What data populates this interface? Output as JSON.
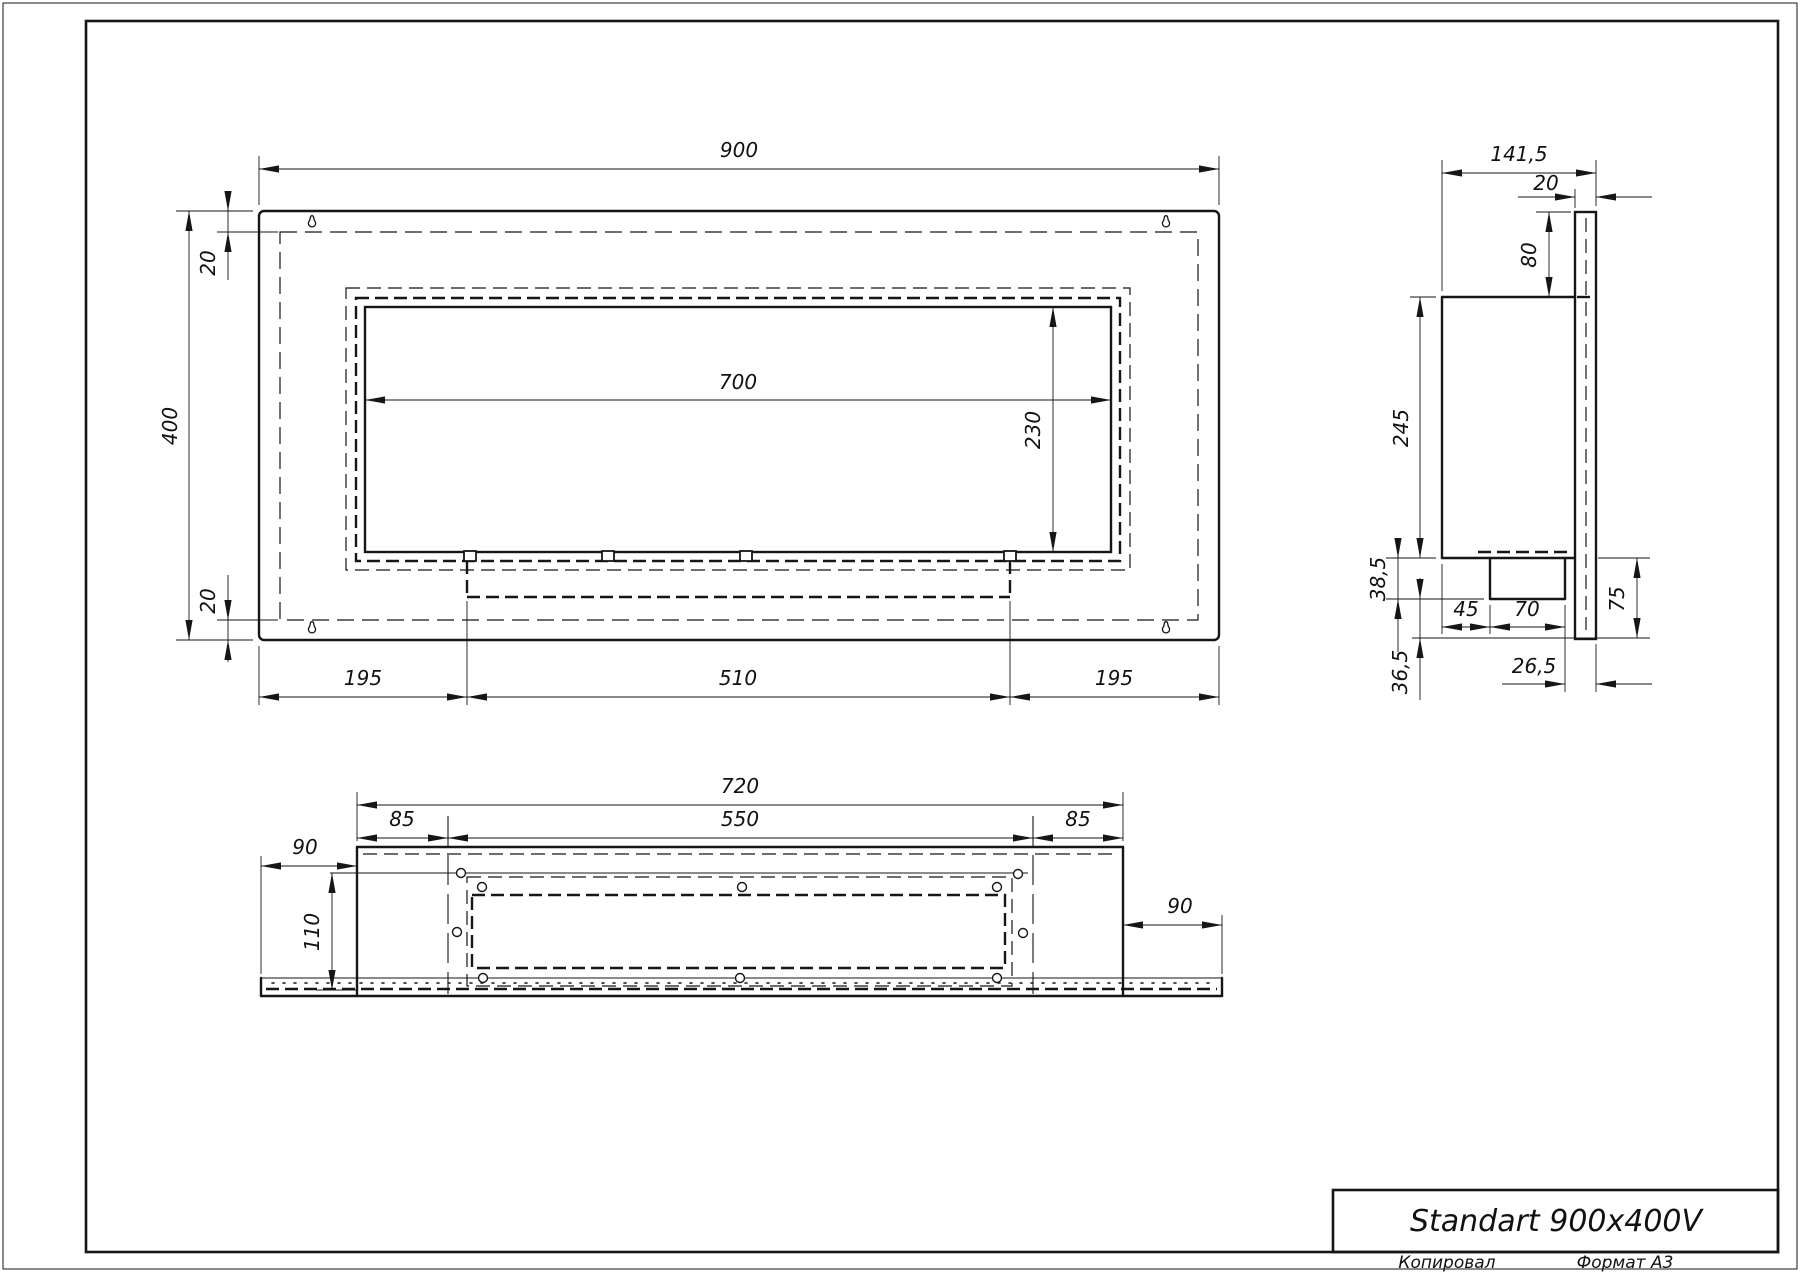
{
  "sheet": {
    "title": "Standart 900x400V",
    "copied_label": "Копировал",
    "format_label": "Формат А3"
  },
  "front_view": {
    "dims": {
      "overall_width": "900",
      "overall_height": "400",
      "flange_top": "20",
      "flange_bottom": "20",
      "opening_width": "700",
      "opening_height": "230",
      "tray_left": "195",
      "tray_width": "510",
      "tray_right": "195"
    }
  },
  "side_view": {
    "dims": {
      "overall_depth": "141,5",
      "plate_thickness": "20",
      "plate_above_body": "80",
      "body_height": "245",
      "tray_drop": "38,5",
      "below_tray": "36,5",
      "tray_offset": "45",
      "tray_depth": "70",
      "plate_below_body": "75",
      "tray_to_plate": "26,5"
    }
  },
  "bottom_view": {
    "dims": {
      "body_width": "720",
      "zone_left": "85",
      "mount_width": "550",
      "zone_right": "85",
      "band_left": "90",
      "mount_depth": "110",
      "band_right": "90"
    }
  }
}
